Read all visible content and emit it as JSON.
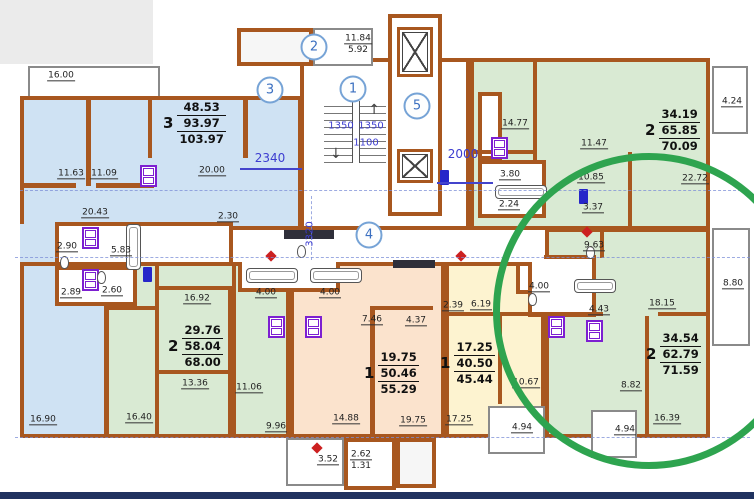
{
  "canvas": {
    "width": 754,
    "height": 499,
    "background": "#ffffff"
  },
  "palette": {
    "wall": "#a8571f",
    "apartment_blue": "#cfe2f3",
    "apartment_green": "#d9ead3",
    "apartment_peach": "#fbe3cd",
    "apartment_yellow": "#fdf3d0",
    "highlight_green": "#2ea44f",
    "dim_blue": "#3d3dd0",
    "axis_bubble_blue": "#3a6fc0",
    "fixture_purple": "#7d1fd1",
    "fixture_blue": "#2626c9",
    "mark_red": "#cc2020",
    "page_corner_gray": "#ebebeb",
    "bottom_bar_navy": "#20325f"
  },
  "apartments": [
    {
      "num": "3",
      "areas": [
        "48.53",
        "93.97",
        "103.97"
      ],
      "x": 163,
      "y": 100
    },
    {
      "num": "2",
      "areas": [
        "34.19",
        "65.85",
        "70.09"
      ],
      "x": 645,
      "y": 107
    },
    {
      "num": "2",
      "areas": [
        "34.54",
        "62.79",
        "71.59"
      ],
      "x": 646,
      "y": 331
    },
    {
      "num": "2",
      "areas": [
        "29.76",
        "58.04",
        "68.00"
      ],
      "x": 168,
      "y": 323
    },
    {
      "num": "1",
      "areas": [
        "19.75",
        "50.46",
        "55.29"
      ],
      "x": 364,
      "y": 350
    },
    {
      "num": "1",
      "areas": [
        "17.25",
        "40.50",
        "45.44"
      ],
      "x": 440,
      "y": 340
    }
  ],
  "room_labels": [
    {
      "t": "16.00",
      "x": 61,
      "y": 76
    },
    {
      "t": "11.63",
      "x": 71,
      "y": 174
    },
    {
      "t": "11.09",
      "x": 104,
      "y": 174
    },
    {
      "t": "20.00",
      "x": 212,
      "y": 171
    },
    {
      "t": "2.30",
      "x": 228,
      "y": 217
    },
    {
      "t": "20.43",
      "x": 95,
      "y": 213
    },
    {
      "t": "2.90",
      "x": 67,
      "y": 247
    },
    {
      "t": "5.83",
      "x": 121,
      "y": 251
    },
    {
      "t": "2.89",
      "x": 71,
      "y": 293
    },
    {
      "t": "2.60",
      "x": 112,
      "y": 291
    },
    {
      "t": "16.92",
      "x": 197,
      "y": 299
    },
    {
      "t": "13.36",
      "x": 195,
      "y": 384
    },
    {
      "t": "11.06",
      "x": 249,
      "y": 388
    },
    {
      "t": "16.90",
      "x": 43,
      "y": 420
    },
    {
      "t": "16.40",
      "x": 139,
      "y": 418
    },
    {
      "t": "9.96",
      "x": 276,
      "y": 427
    },
    {
      "t": "4.00",
      "x": 266,
      "y": 293
    },
    {
      "t": "4.00",
      "x": 330,
      "y": 293
    },
    {
      "t": "7.46",
      "x": 372,
      "y": 320
    },
    {
      "t": "4.37",
      "x": 416,
      "y": 321
    },
    {
      "t": "14.88",
      "x": 346,
      "y": 419
    },
    {
      "t": "19.75",
      "x": 413,
      "y": 421
    },
    {
      "t": "3.52",
      "x": 328,
      "y": 460
    },
    {
      "t": "2.62",
      "x": 361,
      "y": 455
    },
    {
      "t": "1.31",
      "x": 361,
      "y": 466,
      "u": false
    },
    {
      "t": "2.39",
      "x": 453,
      "y": 306
    },
    {
      "t": "6.19",
      "x": 481,
      "y": 305
    },
    {
      "t": "17.25",
      "x": 459,
      "y": 420
    },
    {
      "t": "10.67",
      "x": 526,
      "y": 383
    },
    {
      "t": "9.63",
      "x": 594,
      "y": 246
    },
    {
      "t": "4.00",
      "x": 539,
      "y": 287
    },
    {
      "t": "4.43",
      "x": 599,
      "y": 310
    },
    {
      "t": "18.15",
      "x": 662,
      "y": 304
    },
    {
      "t": "8.80",
      "x": 733,
      "y": 284
    },
    {
      "t": "8.82",
      "x": 631,
      "y": 386
    },
    {
      "t": "16.39",
      "x": 667,
      "y": 419
    },
    {
      "t": "4.94",
      "x": 522,
      "y": 428
    },
    {
      "t": "4.94",
      "x": 625,
      "y": 430
    },
    {
      "t": "14.77",
      "x": 515,
      "y": 124
    },
    {
      "t": "11.47",
      "x": 594,
      "y": 144
    },
    {
      "t": "3.80",
      "x": 510,
      "y": 175
    },
    {
      "t": "2.24",
      "x": 509,
      "y": 205
    },
    {
      "t": "3.37",
      "x": 593,
      "y": 208
    },
    {
      "t": "10.85",
      "x": 591,
      "y": 178
    },
    {
      "t": "22.72",
      "x": 695,
      "y": 179
    },
    {
      "t": "4.24",
      "x": 732,
      "y": 102
    },
    {
      "t": "11.84",
      "x": 358,
      "y": 39
    },
    {
      "t": "5.92",
      "x": 358,
      "y": 50,
      "u": false
    }
  ],
  "dim_labels": [
    {
      "t": "2340",
      "x": 270,
      "y": 158
    },
    {
      "t": "2000",
      "x": 463,
      "y": 154
    },
    {
      "t": "1350",
      "x": 341,
      "y": 126,
      "s": 10
    },
    {
      "t": "1350",
      "x": 371,
      "y": 126,
      "s": 10
    },
    {
      "t": "1100",
      "x": 366,
      "y": 143,
      "s": 10
    },
    {
      "t": "3320",
      "x": 310,
      "y": 234,
      "s": 10,
      "rot": true
    }
  ],
  "axis_bubbles": [
    {
      "n": "2",
      "x": 314,
      "y": 47
    },
    {
      "n": "3",
      "x": 270,
      "y": 90
    },
    {
      "n": "1",
      "x": 353,
      "y": 89
    },
    {
      "n": "5",
      "x": 417,
      "y": 106
    },
    {
      "n": "4",
      "x": 369,
      "y": 235
    }
  ],
  "plan": {
    "regions": [
      {
        "n": "balcony-16-00",
        "x": 28,
        "y": 66,
        "w": 132,
        "h": 32,
        "f": "#ffffff",
        "c": "thinb"
      },
      {
        "n": "apt3-main",
        "x": 20,
        "y": 96,
        "w": 282,
        "h": 134,
        "f": "blue"
      },
      {
        "n": "apt3-hall-connector",
        "x": 20,
        "y": 224,
        "w": 40,
        "h": 44,
        "f": "blue",
        "c": "noborder"
      },
      {
        "n": "apt3-room-16-90",
        "x": 20,
        "y": 262,
        "w": 88,
        "h": 176,
        "f": "blue"
      },
      {
        "n": "apt2bl-region",
        "x": 105,
        "y": 262,
        "w": 185,
        "h": 176,
        "f": "green"
      },
      {
        "n": "bath-strip-left",
        "x": 55,
        "y": 222,
        "w": 178,
        "h": 44,
        "f": "#ffffff",
        "c": "tiled"
      },
      {
        "n": "wc-left-lower",
        "x": 55,
        "y": 266,
        "w": 82,
        "h": 40,
        "f": "#ffffff",
        "c": "tiled"
      },
      {
        "n": "apt1c-region",
        "x": 290,
        "y": 262,
        "w": 155,
        "h": 176,
        "f": "peach"
      },
      {
        "n": "kitchen-11-06",
        "x": 232,
        "y": 262,
        "w": 58,
        "h": 176,
        "f": "green"
      },
      {
        "n": "bath-strip-center",
        "x": 238,
        "y": 258,
        "w": 102,
        "h": 34,
        "f": "#ffffff",
        "c": "tiled"
      },
      {
        "n": "apt1y-region",
        "x": 445,
        "y": 262,
        "w": 100,
        "h": 176,
        "f": "yellow"
      },
      {
        "n": "bath-4-00-yellow",
        "x": 516,
        "y": 262,
        "w": 29,
        "h": 32,
        "f": "#ffffff"
      },
      {
        "n": "apt2circ-region",
        "x": 545,
        "y": 228,
        "w": 165,
        "h": 210,
        "f": "green"
      },
      {
        "n": "bath-cluster-circ",
        "x": 528,
        "y": 255,
        "w": 68,
        "h": 62,
        "f": "#ffffff",
        "c": "tiled"
      },
      {
        "n": "apt2tr-region",
        "x": 470,
        "y": 58,
        "w": 240,
        "h": 172,
        "f": "green"
      },
      {
        "n": "bath-col-tr",
        "x": 478,
        "y": 92,
        "w": 24,
        "h": 68,
        "f": "#ffffff",
        "c": "tiled"
      },
      {
        "n": "bath-tr-lower",
        "x": 478,
        "y": 160,
        "w": 68,
        "h": 58,
        "f": "#ffffff",
        "c": "tiled"
      },
      {
        "n": "balcony-4-24",
        "x": 712,
        "y": 66,
        "w": 36,
        "h": 68,
        "f": "#ffffff",
        "c": "thinb"
      },
      {
        "n": "loggia-8-80",
        "x": 712,
        "y": 228,
        "w": 38,
        "h": 118,
        "f": "#ffffff",
        "c": "thinb"
      },
      {
        "n": "stair-core",
        "x": 300,
        "y": 58,
        "w": 170,
        "h": 172,
        "f": "#ffffff"
      },
      {
        "n": "elevator-shaft",
        "x": 388,
        "y": 14,
        "w": 54,
        "h": 202,
        "f": "#ffffff"
      },
      {
        "n": "entry-hatch",
        "x": 237,
        "y": 28,
        "w": 76,
        "h": 38,
        "f": "#f6f6f6",
        "c": "hatch"
      },
      {
        "n": "entry-landing",
        "x": 313,
        "y": 28,
        "w": 60,
        "h": 38,
        "f": "#ffffff",
        "c": "thinb"
      },
      {
        "n": "corridor-mid",
        "x": 234,
        "y": 232,
        "w": 310,
        "h": 30,
        "f": "#ffffff",
        "c": "noborder"
      },
      {
        "n": "balcony-4-94-left",
        "x": 488,
        "y": 406,
        "w": 57,
        "h": 48,
        "f": "#ffffff",
        "c": "thinb"
      },
      {
        "n": "balcony-4-94-right",
        "x": 591,
        "y": 410,
        "w": 46,
        "h": 48,
        "f": "#ffffff",
        "c": "thinb"
      },
      {
        "n": "balcony-3-52",
        "x": 286,
        "y": 438,
        "w": 58,
        "h": 48,
        "f": "#ffffff",
        "c": "thinb"
      },
      {
        "n": "exit-vestibule",
        "x": 344,
        "y": 438,
        "w": 52,
        "h": 52,
        "f": "#ffffff"
      },
      {
        "n": "ramp-hatch",
        "x": 396,
        "y": 438,
        "w": 40,
        "h": 50,
        "f": "#f6f6f6",
        "c": "hatch"
      }
    ],
    "walls": [
      {
        "x": 86,
        "y": 100,
        "w": 5,
        "h": 86
      },
      {
        "x": 148,
        "y": 100,
        "w": 4,
        "h": 58
      },
      {
        "x": 243,
        "y": 96,
        "w": 5,
        "h": 62
      },
      {
        "x": 24,
        "y": 183,
        "w": 52,
        "h": 5
      },
      {
        "x": 96,
        "y": 183,
        "w": 58,
        "h": 5
      },
      {
        "x": 155,
        "y": 262,
        "w": 4,
        "h": 174
      },
      {
        "x": 158,
        "y": 286,
        "w": 74,
        "h": 4
      },
      {
        "x": 158,
        "y": 370,
        "w": 74,
        "h": 4
      },
      {
        "x": 228,
        "y": 290,
        "w": 4,
        "h": 146
      },
      {
        "x": 105,
        "y": 306,
        "w": 50,
        "h": 4
      },
      {
        "x": 370,
        "y": 306,
        "w": 5,
        "h": 132
      },
      {
        "x": 375,
        "y": 306,
        "w": 58,
        "h": 4
      },
      {
        "x": 445,
        "y": 312,
        "w": 100,
        "h": 4
      },
      {
        "x": 498,
        "y": 316,
        "w": 4,
        "h": 88
      },
      {
        "x": 645,
        "y": 316,
        "w": 4,
        "h": 122
      },
      {
        "x": 545,
        "y": 312,
        "w": 58,
        "h": 4
      },
      {
        "x": 658,
        "y": 312,
        "w": 52,
        "h": 4
      },
      {
        "x": 600,
        "y": 230,
        "w": 4,
        "h": 28
      },
      {
        "x": 533,
        "y": 60,
        "w": 4,
        "h": 102
      },
      {
        "x": 628,
        "y": 152,
        "w": 4,
        "h": 78
      },
      {
        "x": 470,
        "y": 150,
        "w": 65,
        "h": 4
      }
    ],
    "dark_bars": [
      {
        "x": 284,
        "y": 230,
        "w": 50,
        "h": 9
      },
      {
        "x": 393,
        "y": 260,
        "w": 42,
        "h": 8
      }
    ],
    "axis_lines": [
      {
        "x": 15,
        "y": 257,
        "w": 735
      },
      {
        "x": 20,
        "y": 190,
        "w": 726
      },
      {
        "x": 15,
        "y": 437,
        "w": 735
      },
      {
        "x": 311,
        "y": 196,
        "h": 64,
        "vert": true
      }
    ],
    "dim_lines": [
      {
        "x": 240,
        "y": 168,
        "w": 62
      },
      {
        "x": 437,
        "y": 182,
        "w": 56
      }
    ]
  },
  "fixtures": {
    "stoves": [
      {
        "x": 140,
        "y": 165
      },
      {
        "x": 491,
        "y": 137
      },
      {
        "x": 82,
        "y": 227
      },
      {
        "x": 82,
        "y": 269
      },
      {
        "x": 268,
        "y": 316
      },
      {
        "x": 305,
        "y": 316
      },
      {
        "x": 548,
        "y": 316
      },
      {
        "x": 586,
        "y": 320
      }
    ],
    "panels": [
      {
        "x": 440,
        "y": 170
      },
      {
        "x": 579,
        "y": 189
      },
      {
        "x": 143,
        "y": 267
      }
    ],
    "red_marks": [
      {
        "x": 267,
        "y": 252
      },
      {
        "x": 457,
        "y": 252
      },
      {
        "x": 583,
        "y": 228
      },
      {
        "x": 313,
        "y": 444
      }
    ],
    "bathtubs": [
      {
        "x": 495,
        "y": 185,
        "w": 52,
        "h": 14
      },
      {
        "x": 126,
        "y": 224,
        "w": 15,
        "h": 46
      },
      {
        "x": 246,
        "y": 268,
        "w": 52,
        "h": 15
      },
      {
        "x": 310,
        "y": 268,
        "w": 52,
        "h": 15
      },
      {
        "x": 574,
        "y": 279,
        "w": 42,
        "h": 14
      }
    ],
    "toilets": [
      {
        "x": 60,
        "y": 256
      },
      {
        "x": 97,
        "y": 271
      },
      {
        "x": 528,
        "y": 293
      },
      {
        "x": 586,
        "y": 246
      },
      {
        "x": 297,
        "y": 245
      }
    ]
  },
  "stairs": {
    "x": 324,
    "y": 101,
    "w": 62,
    "h": 62,
    "up_arrow": "↑",
    "down_arrow": "↓"
  },
  "elevators": [
    {
      "x": 397,
      "y": 27,
      "w": 36,
      "h": 50
    },
    {
      "x": 397,
      "y": 149,
      "w": 36,
      "h": 34
    }
  ],
  "highlight_circle": {
    "x": 493,
    "y": 153,
    "w": 312,
    "h": 316,
    "stroke": 7
  }
}
